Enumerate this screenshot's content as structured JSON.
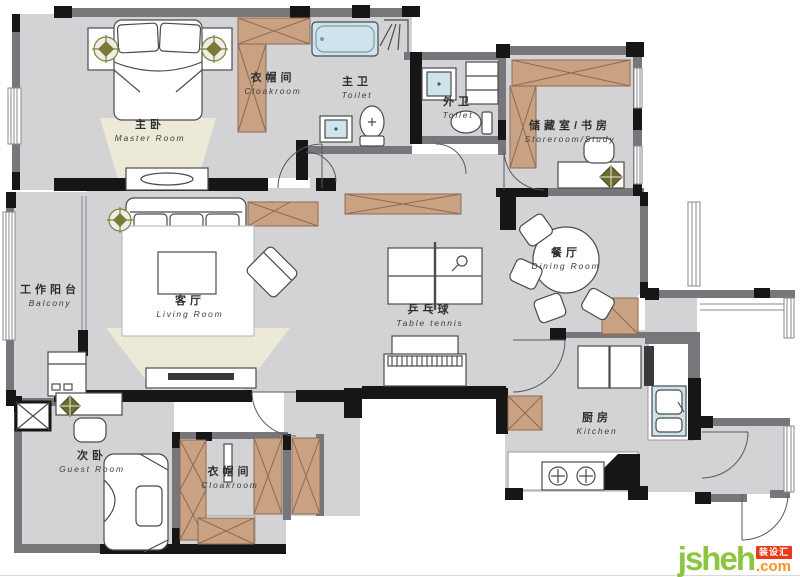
{
  "rooms": [
    {
      "id": "master",
      "cn": "主卧",
      "en": "Master Room"
    },
    {
      "id": "cloakroom-top",
      "cn": "衣帽间",
      "en": "Cloakroom"
    },
    {
      "id": "master-toilet",
      "cn": "主卫",
      "en": "Toilet"
    },
    {
      "id": "guest-toilet",
      "cn": "外卫",
      "en": "Toilet"
    },
    {
      "id": "storeroom-study",
      "cn": "储藏室/书房",
      "en": "Storeroom/Study"
    },
    {
      "id": "balcony",
      "cn": "工作阳台",
      "en": "Balcony"
    },
    {
      "id": "living",
      "cn": "客厅",
      "en": "Living Room"
    },
    {
      "id": "table-tennis",
      "cn": "乒乓球",
      "en": "Table tennis"
    },
    {
      "id": "dining",
      "cn": "餐厅",
      "en": "Dining Room"
    },
    {
      "id": "kitchen",
      "cn": "厨房",
      "en": "Kitchen"
    },
    {
      "id": "guest-room",
      "cn": "次卧",
      "en": "Guest Room"
    },
    {
      "id": "cloakroom-bottom",
      "cn": "衣帽间",
      "en": "Cloakroom"
    }
  ],
  "watermark": {
    "name": "jsheh",
    "badge": "装设汇",
    "tld": ".com"
  },
  "colors": {
    "floor": "#d3d3d5",
    "wall_gray": "#77777b",
    "wall_black": "#161616",
    "cabinet_brown": "#c9a183",
    "cabinet_line": "#8d6b52",
    "water_blue": "#cde4ec",
    "beam_yellow": "#f3efd6",
    "logo_green": "#8cc63f",
    "logo_red": "#e8391a",
    "logo_orange": "#f7941d"
  }
}
